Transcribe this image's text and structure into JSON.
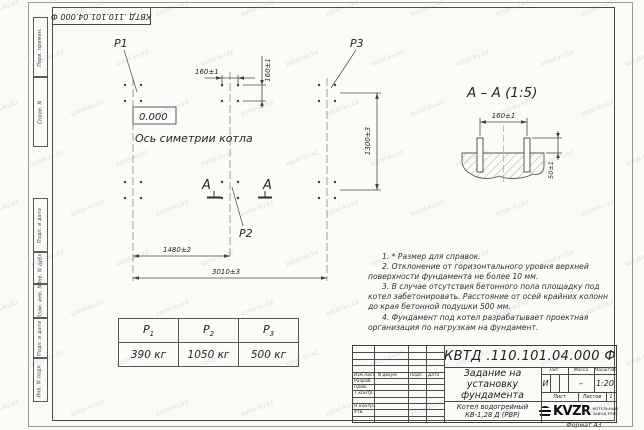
{
  "sheet": {
    "corner_stamp": "КВТД .110.101.04.000 Ф",
    "format_note": "Формат А3",
    "watermark": "kotel-kv.kz"
  },
  "margin_labels": {
    "top": [
      "Перв. примен.",
      "Справ. N"
    ],
    "bottom": [
      "Подп. и дата",
      "Инв. N дубл.",
      "Взам. инв. N",
      "Подп. и дата",
      "Инв. N подл."
    ]
  },
  "plan": {
    "p1": "P1",
    "p2": "P2",
    "p3": "P3",
    "level_mark": "0.000",
    "symmetry_axis_label": "Ось симетрии котла",
    "section_letter_left": "А",
    "section_letter_right": "А",
    "dim_bolt_spacing_h": "160±1",
    "dim_bolt_spacing_v": "160±1",
    "dim_width": "1300±3",
    "dim_span_mid": "1480±2",
    "dim_span_full": "3010±3"
  },
  "section_view": {
    "title": "А – А (1:5)",
    "dim_bolt_spacing": "160±1",
    "dim_bolt_height": "50±1"
  },
  "notes": [
    "1. * Размер для справок.",
    "2. Отклонение от горизонтального уровня верхней поверхности фундамента не более 10 мм.",
    "3. В случае отсутствия бетонного пола площадку под котел забетонировать. Расстояние от осей крайних колонн до края бетонной подушки 500 мм.",
    "4. Фундамент под котел разрабатывает проектная организация по нагрузкам на фундамент."
  ],
  "load_table": {
    "headers": [
      {
        "base": "P",
        "sub": "1"
      },
      {
        "base": "P",
        "sub": "2"
      },
      {
        "base": "P",
        "sub": "3"
      }
    ],
    "values": [
      "390 кг",
      "1050 кг",
      "500 кг"
    ]
  },
  "title_block": {
    "doc_number": "КВТД .110.101.04.000 Ф",
    "doc_title": "Задание на установку фундамента",
    "product_name": "Котел водогрейный КВ-1,28 Д (РВР)",
    "header_cols": [
      "Изм.Лист",
      "N докум.",
      "Подп.",
      "Дата"
    ],
    "sign_rows": [
      "Разраб.",
      "Пров.",
      "Т.контр.",
      "Н.контр.",
      "Утв."
    ],
    "lit_label": "Лит.",
    "lit_value": "И",
    "mass_label": "Масса",
    "mass_value": "–",
    "scale_label": "Масштаб",
    "scale_value": "1:20",
    "sheet_label": "Лист",
    "sheets_label": "Листов",
    "sheets_value": "1",
    "logo_text": "KVZR",
    "logo_tagline_1": "КОТЕЛЬНЫЙ",
    "logo_tagline_2": "ЗАВОД РЭП"
  }
}
